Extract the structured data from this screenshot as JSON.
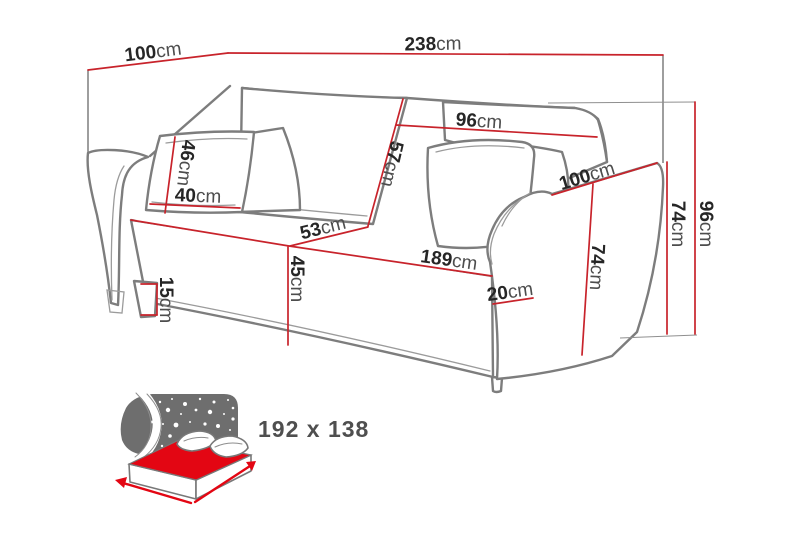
{
  "meta": {
    "title": "Sofa dimensions diagram"
  },
  "colors": {
    "dimension_red": "#c8232b",
    "bed_red": "#e30613",
    "line_gray": "#7d7d7d",
    "speckle_bg": "#6e6e6e",
    "label_dark": "#262626",
    "unit_gray": "#4d4d4d",
    "icon_label_gray": "#4f4f4f"
  },
  "dims": [
    {
      "id": "top-depth",
      "value": "100",
      "unit": "cm"
    },
    {
      "id": "total-width",
      "value": "238",
      "unit": "cm"
    },
    {
      "id": "backrest-width",
      "value": "96",
      "unit": "cm"
    },
    {
      "id": "backrest-height",
      "value": "57",
      "unit": "cm"
    },
    {
      "id": "pillow-height",
      "value": "46",
      "unit": "cm"
    },
    {
      "id": "pillow-width",
      "value": "40",
      "unit": "cm"
    },
    {
      "id": "seat-depth",
      "value": "53",
      "unit": "cm"
    },
    {
      "id": "seat-height",
      "value": "45",
      "unit": "cm"
    },
    {
      "id": "leg-height",
      "value": "15",
      "unit": "cm"
    },
    {
      "id": "seat-width",
      "value": "189",
      "unit": "cm"
    },
    {
      "id": "armrest-width",
      "value": "20",
      "unit": "cm"
    },
    {
      "id": "armrest-depth",
      "value": "100",
      "unit": "cm"
    },
    {
      "id": "armrest-height-front",
      "value": "74",
      "unit": "cm"
    },
    {
      "id": "armrest-height-outer",
      "value": "74",
      "unit": "cm"
    },
    {
      "id": "total-height",
      "value": "96",
      "unit": "cm"
    }
  ],
  "bed_icon": {
    "size_label": "192 x 138"
  }
}
